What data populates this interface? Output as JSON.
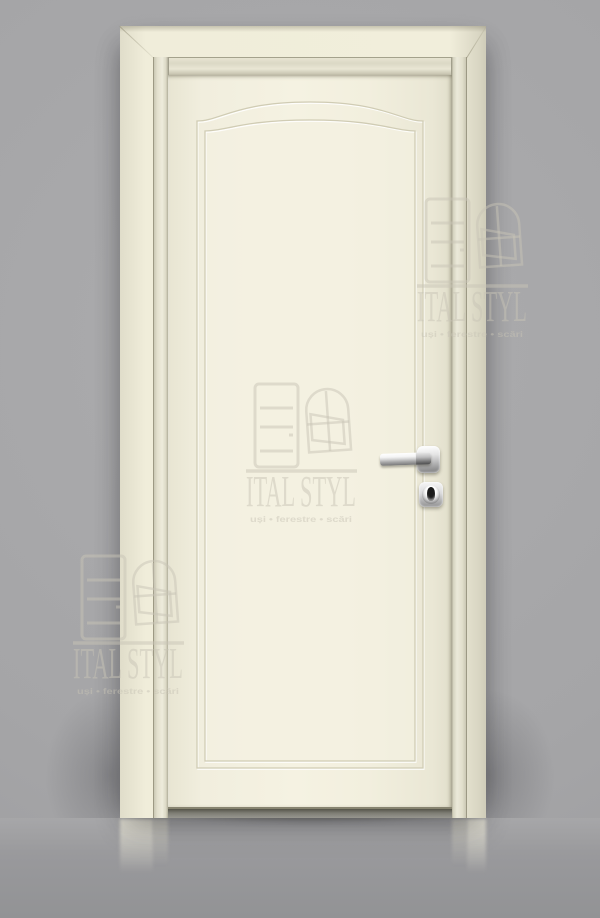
{
  "watermark": {
    "brand": "ITAL STYL",
    "tagline": "uși • ferestre • scări",
    "color": "#c8c4b5",
    "icons": [
      "door-icon",
      "window-icon"
    ],
    "instances": 3
  },
  "scene": {
    "description": "Studio product photo of a closed cream classic interior door with casing, arched top panel moulding, chrome lever handle and square key escutcheon, on a grey wall with reflective grey floor",
    "colors": {
      "wall_gray": "#a3a3a5",
      "floor_gray": "#97979a",
      "door_cream": "#f2efde",
      "casing_cream": "#eeebd8",
      "moulding_groove": "#d0ccb4",
      "hardware_chrome": "#d8d8d9",
      "keyhole_black": "#1c1c1c"
    },
    "objects": [
      "door-casing",
      "door-leaf",
      "arched-panel-moulding",
      "lever-handle",
      "handle-rosette",
      "key-escutcheon",
      "keyhole",
      "floor-reflection"
    ]
  }
}
